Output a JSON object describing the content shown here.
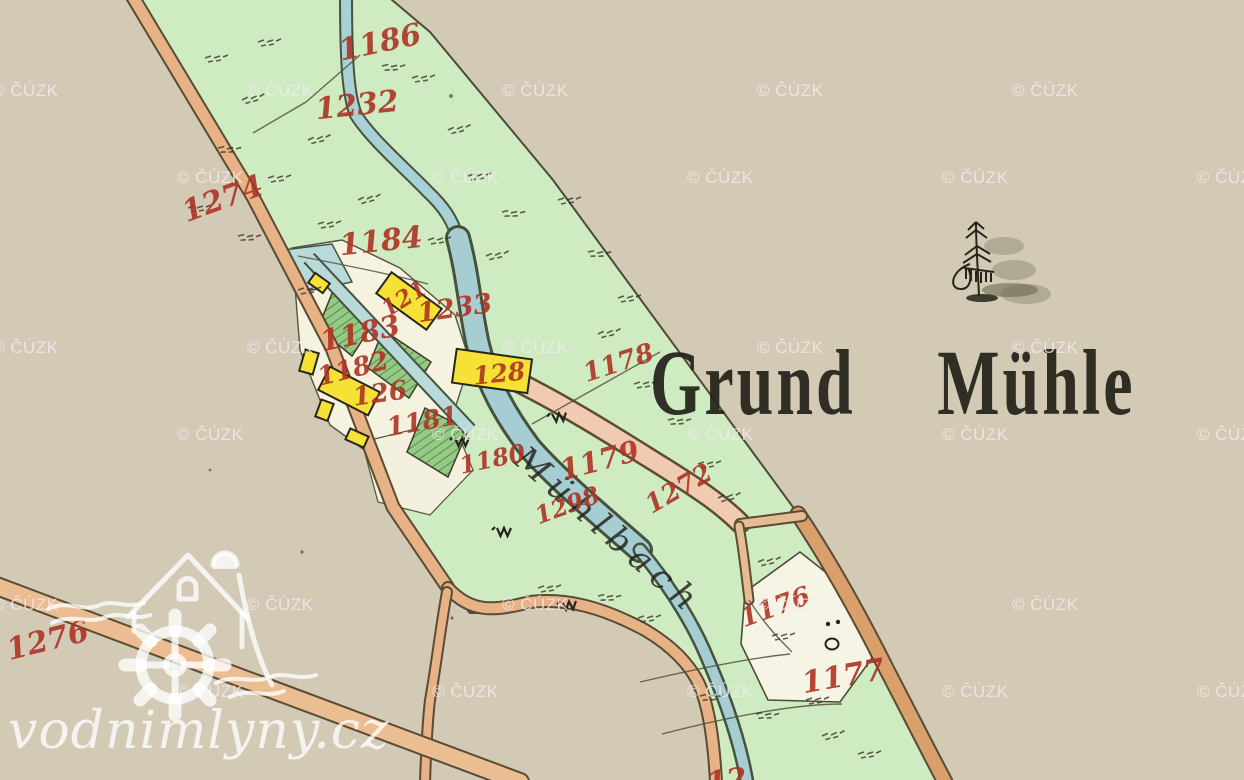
{
  "title": {
    "text": "Grund Mühle"
  },
  "stream": {
    "name": "Mühlbach"
  },
  "parcels": [
    "1186",
    "1232",
    "1274",
    "1184",
    "121",
    "1233",
    "1183",
    "1182",
    "126",
    "128",
    "1181",
    "1178",
    "1179",
    "1272",
    "1180",
    "1298",
    "1276",
    "1176",
    "1177",
    "12"
  ],
  "watermark": {
    "text": "© ČÚZK"
  },
  "logo": {
    "text": "vodnimlyny.cz"
  },
  "symbols": {
    "tree_icon": "conifer-tree-with-shadow",
    "meadow_icon": "w-meadow-mark",
    "circle_icon": "o-umlaut-parcel-mark",
    "logo_icon": "watermill-house-with-wheel-and-waves"
  },
  "colors": {
    "background": "#d2cab5",
    "meadow": "#cfebc1",
    "garden": "#94ca85",
    "water": "#a6cdd2",
    "road": "#e7b286",
    "road_light": "#f0cbb2",
    "road_dark": "#d9a06c",
    "building": "#f6e235",
    "parcel_number_red": "#ae3424",
    "ink": "#26241c",
    "watermark_white": "#f5eaf2"
  }
}
